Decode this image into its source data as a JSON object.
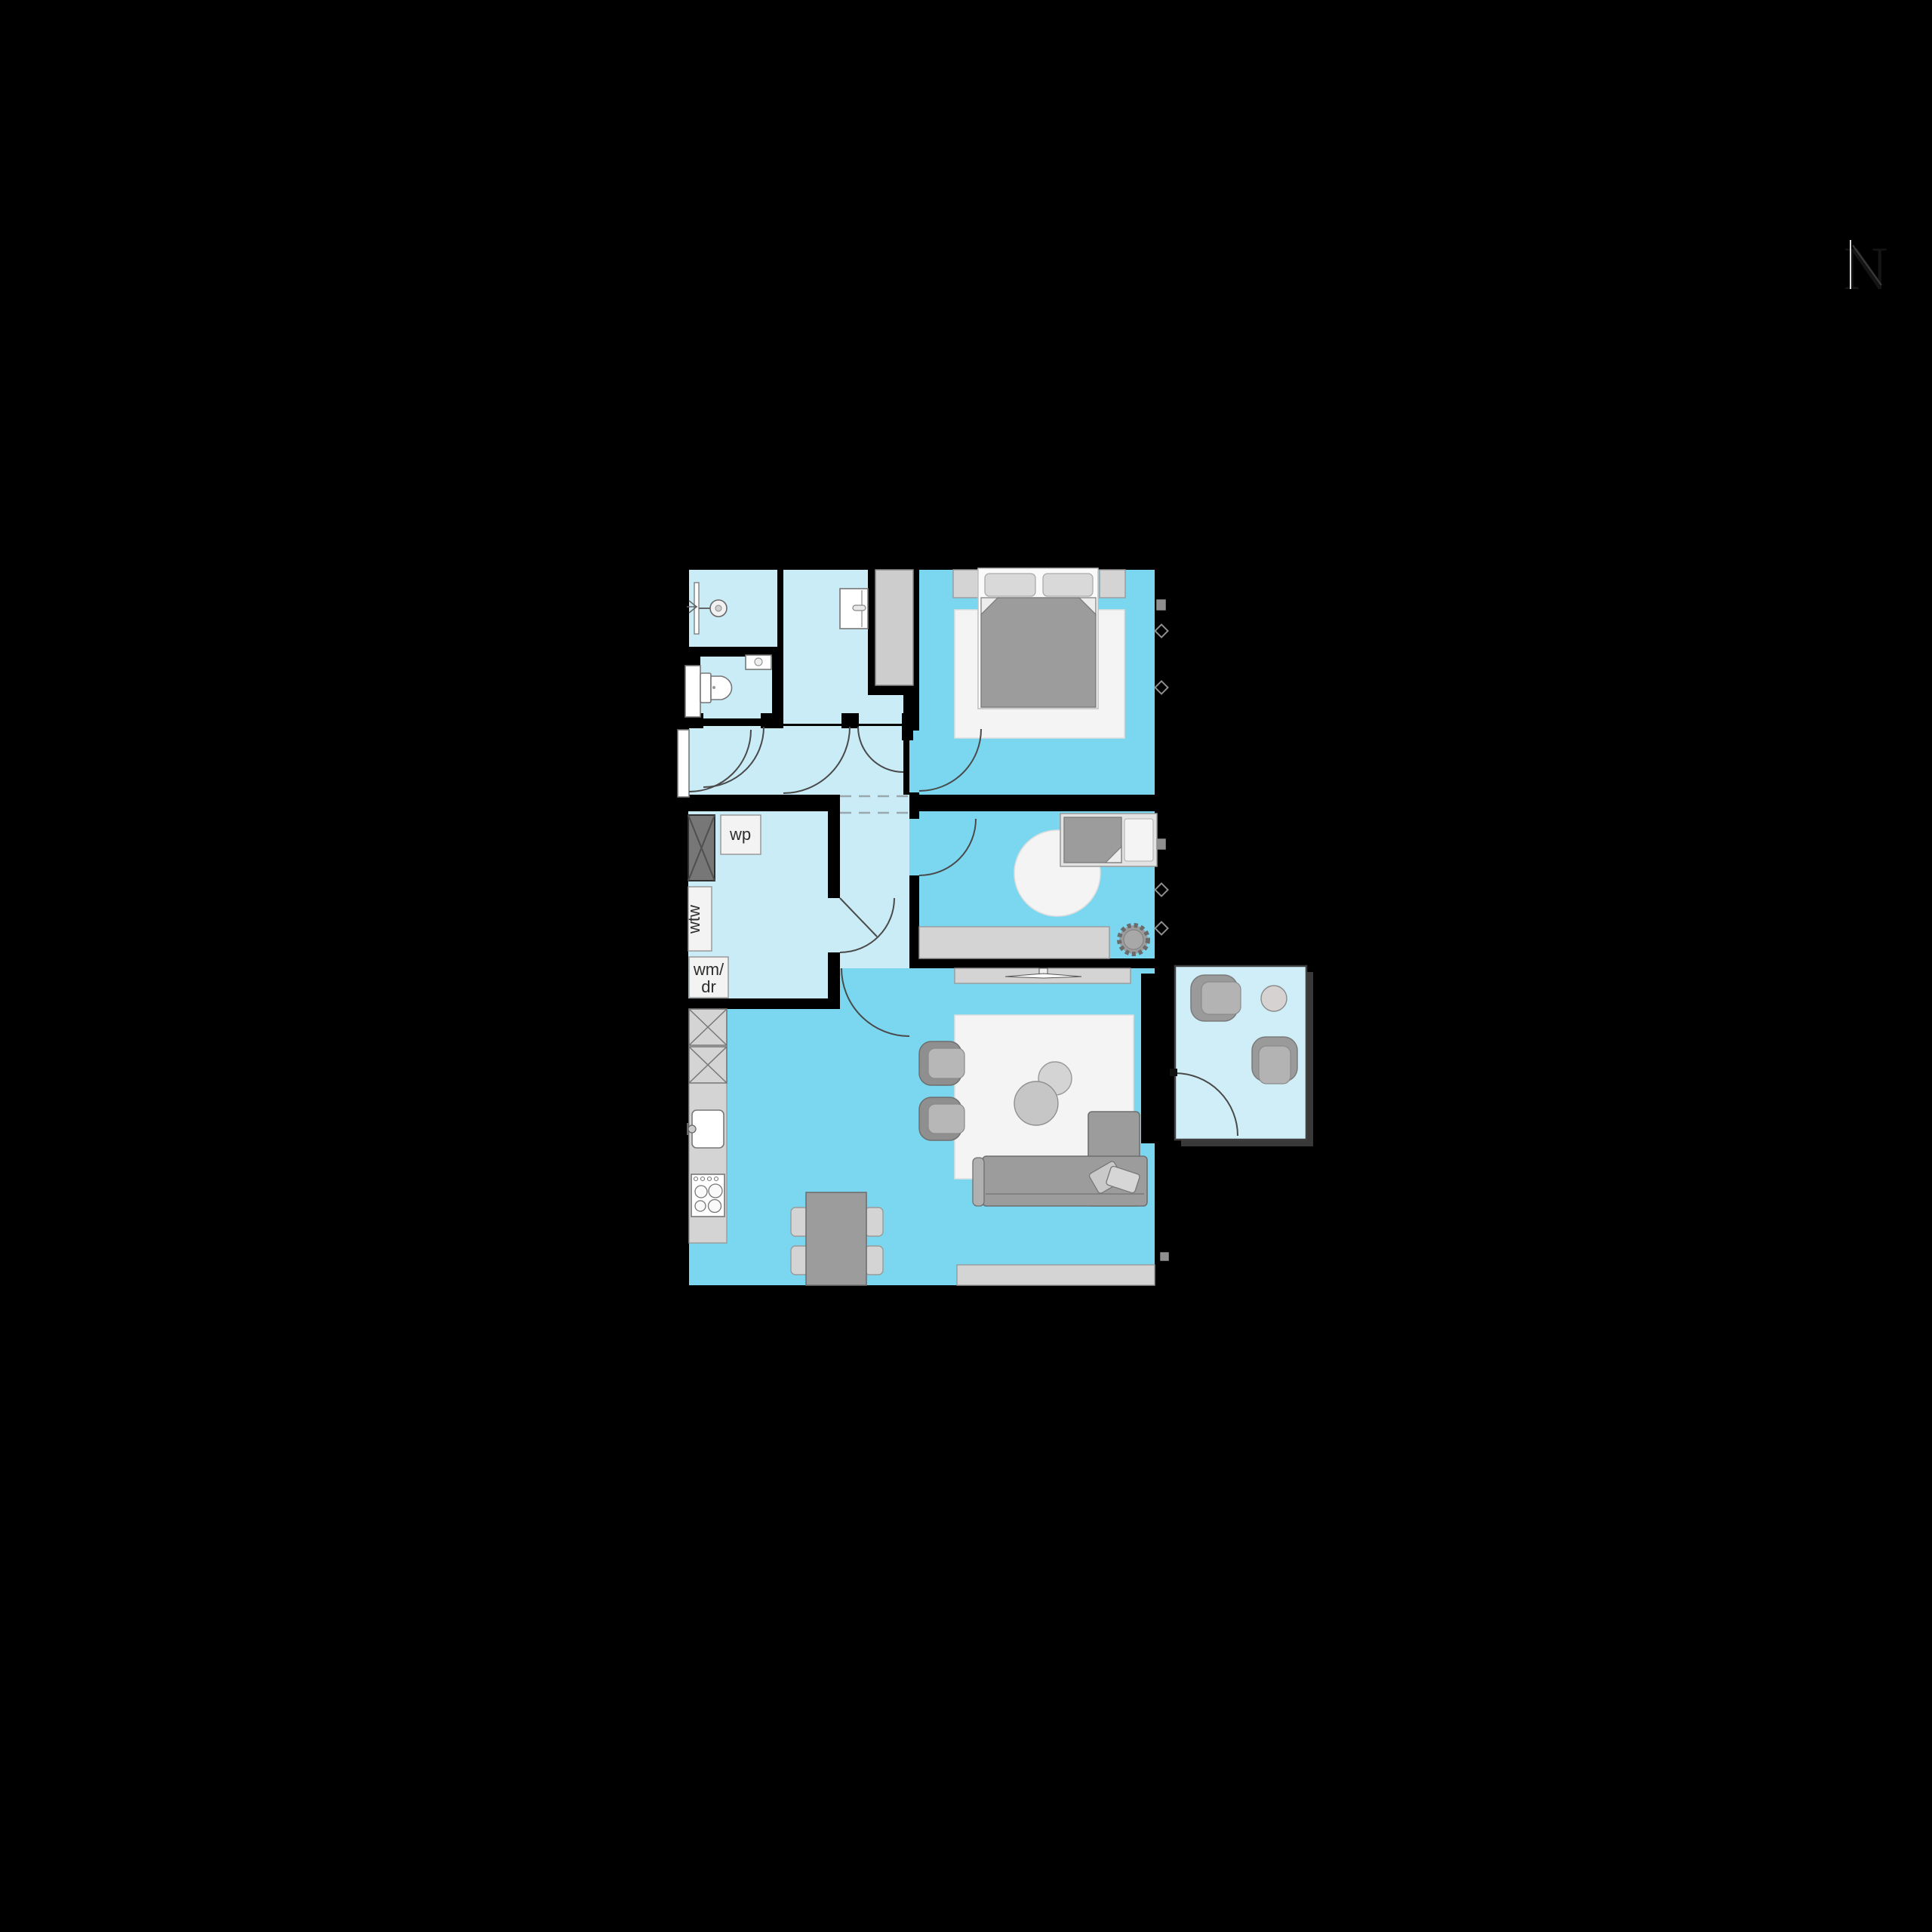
{
  "north_indicator": {
    "label": "N"
  },
  "plan": {
    "labels": {
      "heat_pump": "wp",
      "heat_recovery": "wtw",
      "washer_dryer_line1": "wm/",
      "washer_dryer_line2": "dr"
    }
  },
  "colors": {
    "background": "#000000",
    "room_light": "#c9ecf7",
    "room_blue": "#7bd7f0",
    "balcony_light": "#cfeef7",
    "shaft_gray": "#cdcdcd",
    "shaft_dark": "#777777",
    "furniture_mid": "#9c9c9c",
    "furniture_light": "#d4d4d4",
    "rug_white": "#f4f4f4",
    "line_dark": "#4a4a4a"
  }
}
